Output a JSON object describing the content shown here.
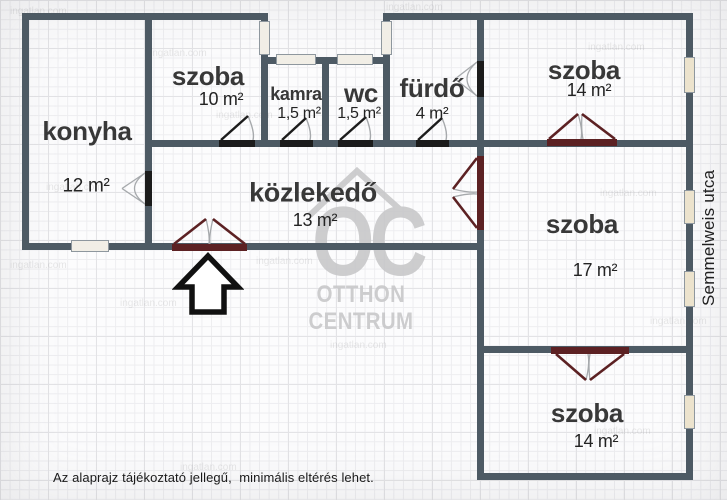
{
  "plan": {
    "rooms": [
      {
        "name": "konyha",
        "area": "12 m²"
      },
      {
        "name": "szoba",
        "area": "10 m²"
      },
      {
        "name": "kamra",
        "area": "1,5 m²"
      },
      {
        "name": "wc",
        "area": "1,5 m²"
      },
      {
        "name": "fürdő",
        "area": "4 m²"
      },
      {
        "name": "szoba",
        "area": "14 m²"
      },
      {
        "name": "közlekedő",
        "area": "13 m²"
      },
      {
        "name": "szoba",
        "area": "17 m²"
      },
      {
        "name": "szoba",
        "area": "14 m²"
      }
    ],
    "street_label": "Semmelweis utca",
    "disclaimer": "Az alaprajz tájékoztató jellegű,  minimális eltérés lehet.",
    "watermark": {
      "logo": "OC",
      "line1": "OTTHON",
      "line2": "CENTRUM"
    },
    "photo_watermark": "ingatlan.com",
    "colors": {
      "wall": "#4d5a64",
      "single_door": "#1c1c1c",
      "double_door": "#5c2123",
      "door_arc": "#a6a9ac",
      "window_fill": "#ece3cd",
      "window_border": "#8e979e",
      "label": "#333333",
      "watermark_gray": "#c8c8ca",
      "arrow": "#111111"
    }
  }
}
